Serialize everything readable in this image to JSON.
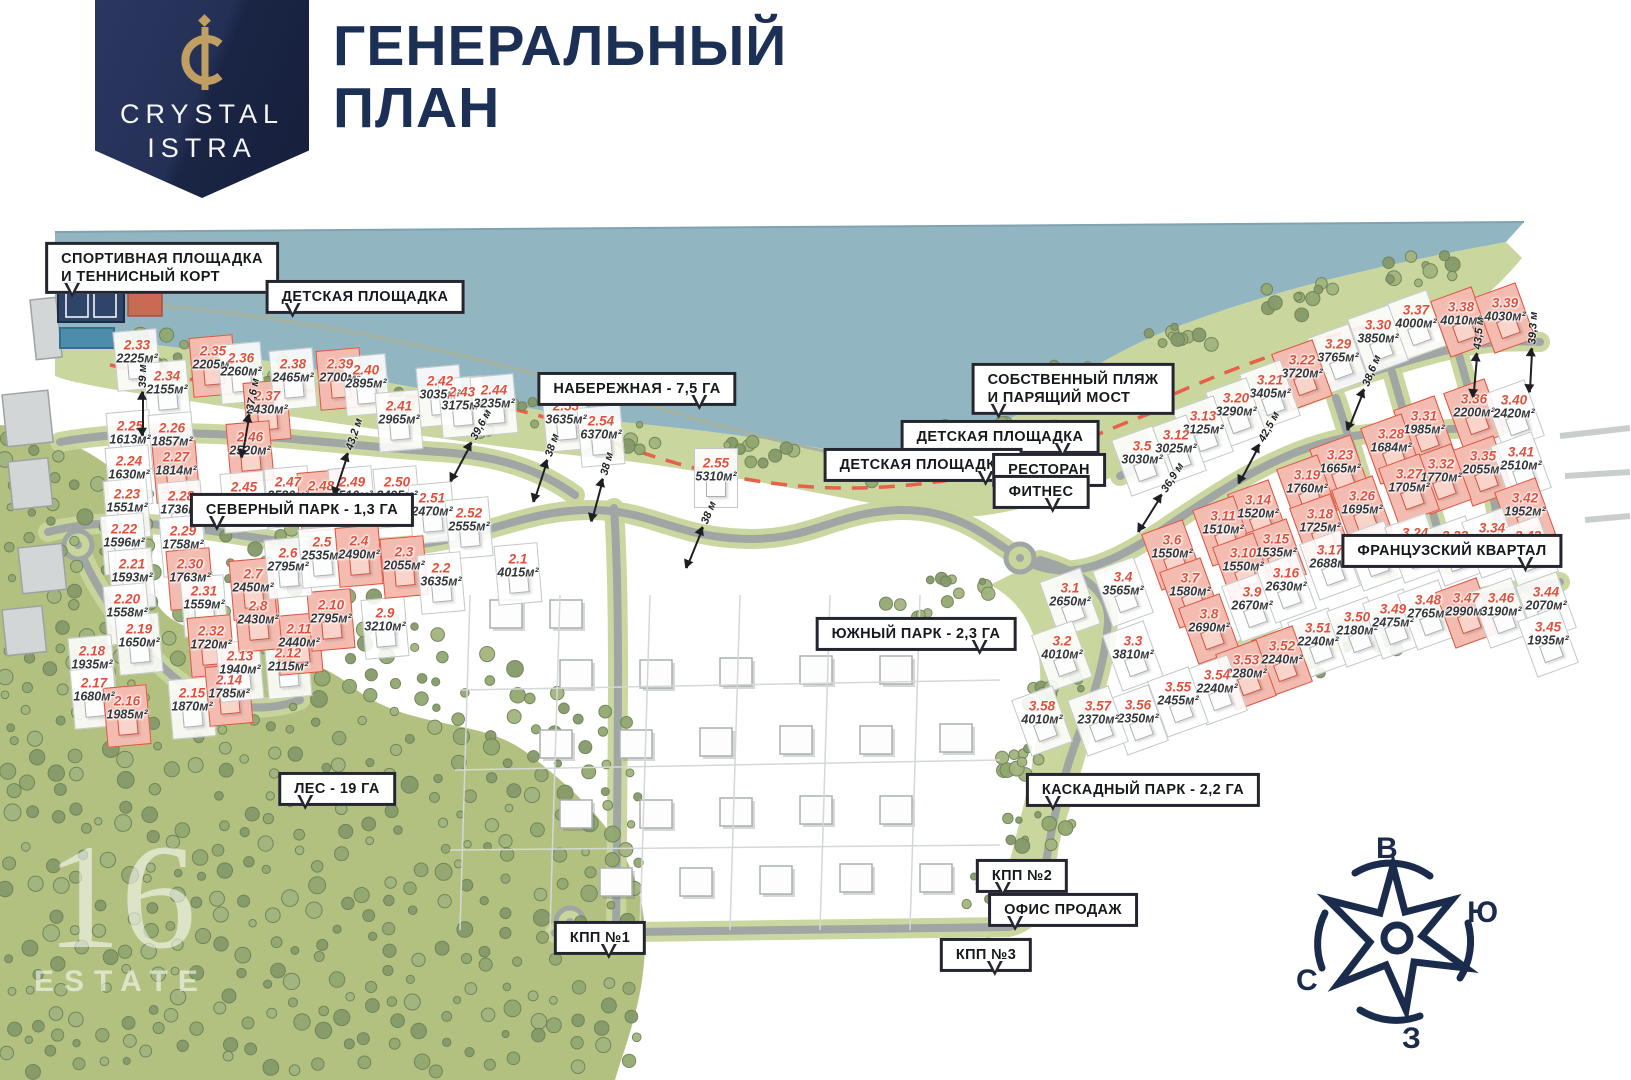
{
  "header": {
    "logo_line1": "CRYSTAL",
    "logo_line2": "ISTRA",
    "title_line1": "ГЕНЕРАЛЬНЫЙ",
    "title_line2": "ПЛАН"
  },
  "colors": {
    "navy": "#1c2f55",
    "gold": "#bf9f62",
    "water": "#92b5c2",
    "shore_green": "#c9d69d",
    "forest_green": "#b3c180",
    "tree_green": "#8ba06c",
    "road_gray": "#a0a6a4",
    "road_edge_green": "#c8d59b",
    "plot_number_red": "#e2503c",
    "plot_red_fill": "#f4bcb1",
    "plot_red_border": "#dd5642",
    "dashed_line_red": "#e8604c"
  },
  "callouts": [
    {
      "id": "sport-ground",
      "lines": [
        "СПОРТИВНАЯ ПЛОЩАДКА",
        "И ТЕННИСНЫЙ КОРТ"
      ],
      "x": 162,
      "y": 268,
      "tail": "bl"
    },
    {
      "id": "playground-nw",
      "lines": [
        "ДЕТСКАЯ ПЛОЩАДКА"
      ],
      "x": 365,
      "y": 297,
      "tail": "bl"
    },
    {
      "id": "embankment",
      "lines": [
        "НАБЕРЕЖНАЯ - 7,5 ГА"
      ],
      "x": 637,
      "y": 389,
      "tail": "br"
    },
    {
      "id": "own-beach",
      "lines": [
        "СОБСТВЕННЫЙ ПЛЯЖ",
        "И ПАРЯЩИЙ МОСТ"
      ],
      "x": 1073,
      "y": 389,
      "tail": "bl"
    },
    {
      "id": "playground-e",
      "lines": [
        "ДЕТСКАЯ ПЛОЩАДКА"
      ],
      "x": 1000,
      "y": 437,
      "tail": "br"
    },
    {
      "id": "playground-c",
      "lines": [
        "ДЕТСКАЯ ПЛОЩАДКА"
      ],
      "x": 923,
      "y": 465,
      "tail": "br"
    },
    {
      "id": "restaurant",
      "lines": [
        "РЕСТОРАН"
      ],
      "x": 1049,
      "y": 470,
      "tail": "br"
    },
    {
      "id": "fitness",
      "lines": [
        "ФИТНЕС"
      ],
      "x": 1041,
      "y": 492,
      "tail": "br"
    },
    {
      "id": "north-park",
      "lines": [
        "СЕВЕРНЫЙ ПАРК - 1,3 ГА"
      ],
      "x": 302,
      "y": 510,
      "tail": "bl"
    },
    {
      "id": "south-park",
      "lines": [
        "ЮЖНЫЙ ПАРК - 2,3 ГА"
      ],
      "x": 916,
      "y": 634,
      "tail": "br"
    },
    {
      "id": "french-quarter",
      "lines": [
        "ФРАНЦУЗСКИЙ КВАРТАЛ"
      ],
      "x": 1452,
      "y": 551,
      "tail": "br"
    },
    {
      "id": "forest",
      "lines": [
        "ЛЕС - 19 ГА"
      ],
      "x": 337,
      "y": 789,
      "tail": "bl"
    },
    {
      "id": "cascade-park",
      "lines": [
        "КАСКАДНЫЙ ПАРК - 2,2 ГА"
      ],
      "x": 1143,
      "y": 790,
      "tail": "bl"
    },
    {
      "id": "kpp2",
      "lines": [
        "КПП №2"
      ],
      "x": 1022,
      "y": 876,
      "tail": "bl"
    },
    {
      "id": "sales-office",
      "lines": [
        "ОФИС ПРОДАЖ"
      ],
      "x": 1063,
      "y": 910,
      "tail": "bl"
    },
    {
      "id": "kpp1",
      "lines": [
        "КПП №1"
      ],
      "x": 600,
      "y": 938,
      "tail": "br"
    },
    {
      "id": "kpp3",
      "lines": [
        "КПП №3"
      ],
      "x": 986,
      "y": 955,
      "tail": "br"
    }
  ],
  "plots": [
    {
      "id": "2.33",
      "area": "2225м²",
      "x": 137,
      "y": 352,
      "red": false
    },
    {
      "id": "2.34",
      "area": "2155м²",
      "x": 167,
      "y": 383,
      "red": false
    },
    {
      "id": "2.35",
      "area": "2205м²",
      "x": 213,
      "y": 358,
      "red": true
    },
    {
      "id": "2.36",
      "area": "2260м²",
      "x": 241,
      "y": 365,
      "red": false
    },
    {
      "id": "2.37",
      "area": "2430м²",
      "x": 267,
      "y": 403,
      "red": true
    },
    {
      "id": "2.38",
      "area": "2465м²",
      "x": 293,
      "y": 371,
      "red": false
    },
    {
      "id": "2.39",
      "area": "2700м²",
      "x": 340,
      "y": 371,
      "red": true
    },
    {
      "id": "2.40",
      "area": "2895м²",
      "x": 366,
      "y": 377,
      "red": false
    },
    {
      "id": "2.41",
      "area": "2965м²",
      "x": 399,
      "y": 413,
      "red": false
    },
    {
      "id": "2.42",
      "area": "3035м²",
      "x": 440,
      "y": 388,
      "red": false
    },
    {
      "id": "2.43",
      "area": "3175м²",
      "x": 462,
      "y": 399,
      "red": false
    },
    {
      "id": "2.44",
      "area": "3235м²",
      "x": 494,
      "y": 397,
      "red": false
    },
    {
      "id": "2.53",
      "area": "3635м²",
      "x": 566,
      "y": 413,
      "red": false
    },
    {
      "id": "2.54",
      "area": "6370м²",
      "x": 601,
      "y": 428,
      "red": false
    },
    {
      "id": "2.55",
      "area": "5310м²",
      "x": 716,
      "y": 470,
      "red": false
    },
    {
      "id": "2.25",
      "area": "1613м²",
      "x": 130,
      "y": 433,
      "red": false
    },
    {
      "id": "2.26",
      "area": "1857м²",
      "x": 172,
      "y": 435,
      "red": false
    },
    {
      "id": "2.24",
      "area": "1630м²",
      "x": 129,
      "y": 468,
      "red": false
    },
    {
      "id": "2.27",
      "area": "1814м²",
      "x": 176,
      "y": 464,
      "red": true
    },
    {
      "id": "2.46",
      "area": "2520м²",
      "x": 250,
      "y": 444,
      "red": true
    },
    {
      "id": "2.45",
      "area": "2400м²",
      "x": 244,
      "y": 494,
      "red": false
    },
    {
      "id": "2.47",
      "area": "2580м²",
      "x": 288,
      "y": 489,
      "red": false
    },
    {
      "id": "2.48",
      "area": "2520м²",
      "x": 321,
      "y": 493,
      "red": true
    },
    {
      "id": "2.49",
      "area": "2510м²",
      "x": 352,
      "y": 489,
      "red": false
    },
    {
      "id": "2.50",
      "area": "2495м²",
      "x": 397,
      "y": 489,
      "red": false
    },
    {
      "id": "2.51",
      "area": "2470м²",
      "x": 432,
      "y": 505,
      "red": false
    },
    {
      "id": "2.52",
      "area": "2555м²",
      "x": 469,
      "y": 520,
      "red": false
    },
    {
      "id": "2.23",
      "area": "1551м²",
      "x": 127,
      "y": 501,
      "red": false
    },
    {
      "id": "2.28",
      "area": "1736м²",
      "x": 181,
      "y": 503,
      "red": false
    },
    {
      "id": "2.22",
      "area": "1596м²",
      "x": 124,
      "y": 536,
      "red": false
    },
    {
      "id": "2.29",
      "area": "1758м²",
      "x": 183,
      "y": 538,
      "red": false
    },
    {
      "id": "2.21",
      "area": "1593м²",
      "x": 132,
      "y": 571,
      "red": false
    },
    {
      "id": "2.30",
      "area": "1763м²",
      "x": 190,
      "y": 571,
      "red": true
    },
    {
      "id": "2.20",
      "area": "1558м²",
      "x": 127,
      "y": 606,
      "red": false
    },
    {
      "id": "2.31",
      "area": "1559м²",
      "x": 204,
      "y": 598,
      "red": false
    },
    {
      "id": "2.19",
      "area": "1650м²",
      "x": 139,
      "y": 636,
      "red": false
    },
    {
      "id": "2.32",
      "area": "1720м²",
      "x": 211,
      "y": 638,
      "red": true
    },
    {
      "id": "2.18",
      "area": "1935м²",
      "x": 92,
      "y": 658,
      "red": false
    },
    {
      "id": "2.17",
      "area": "1680м²",
      "x": 94,
      "y": 690,
      "red": false
    },
    {
      "id": "2.16",
      "area": "1985м²",
      "x": 127,
      "y": 708,
      "red": true
    },
    {
      "id": "2.15",
      "area": "1870м²",
      "x": 192,
      "y": 700,
      "red": false
    },
    {
      "id": "2.14",
      "area": "1785м²",
      "x": 229,
      "y": 687,
      "red": true
    },
    {
      "id": "2.13",
      "area": "1940м²",
      "x": 240,
      "y": 663,
      "red": false
    },
    {
      "id": "2.12",
      "area": "2115м²",
      "x": 288,
      "y": 660,
      "red": false
    },
    {
      "id": "2.11",
      "area": "2440м²",
      "x": 299,
      "y": 636,
      "red": true
    },
    {
      "id": "2.10",
      "area": "2795м²",
      "x": 331,
      "y": 612,
      "red": true
    },
    {
      "id": "2.9",
      "area": "3210м²",
      "x": 385,
      "y": 620,
      "red": false
    },
    {
      "id": "2.8",
      "area": "2430м²",
      "x": 258,
      "y": 613,
      "red": true
    },
    {
      "id": "2.7",
      "area": "2450м²",
      "x": 253,
      "y": 581,
      "red": true
    },
    {
      "id": "2.6",
      "area": "2795м²",
      "x": 288,
      "y": 560,
      "red": false
    },
    {
      "id": "2.5",
      "area": "2535м²",
      "x": 322,
      "y": 549,
      "red": false
    },
    {
      "id": "2.4",
      "area": "2490м²",
      "x": 359,
      "y": 548,
      "red": true
    },
    {
      "id": "2.3",
      "area": "2055м²",
      "x": 404,
      "y": 559,
      "red": true
    },
    {
      "id": "2.2",
      "area": "3635м²",
      "x": 441,
      "y": 575,
      "red": false
    },
    {
      "id": "2.1",
      "area": "4015м²",
      "x": 518,
      "y": 566,
      "red": false
    },
    {
      "id": "3.37",
      "area": "4000м²",
      "x": 1416,
      "y": 317,
      "red": false
    },
    {
      "id": "3.38",
      "area": "4010м²",
      "x": 1461,
      "y": 314,
      "red": true
    },
    {
      "id": "3.39",
      "area": "4030м²",
      "x": 1505,
      "y": 310,
      "red": true
    },
    {
      "id": "3.30",
      "area": "3850м²",
      "x": 1378,
      "y": 332,
      "red": false
    },
    {
      "id": "3.29",
      "area": "3765м²",
      "x": 1338,
      "y": 351,
      "red": false
    },
    {
      "id": "3.22",
      "area": "3720м²",
      "x": 1302,
      "y": 367,
      "red": true
    },
    {
      "id": "3.21",
      "area": "3405м²",
      "x": 1270,
      "y": 387,
      "red": false
    },
    {
      "id": "3.20",
      "area": "3290м²",
      "x": 1236,
      "y": 405,
      "red": false
    },
    {
      "id": "3.13",
      "area": "3125м²",
      "x": 1203,
      "y": 423,
      "red": false
    },
    {
      "id": "3.12",
      "area": "3025м²",
      "x": 1176,
      "y": 442,
      "red": false
    },
    {
      "id": "3.5",
      "area": "3030м²",
      "x": 1142,
      "y": 453,
      "red": false
    },
    {
      "id": "3.36",
      "area": "2200м²",
      "x": 1474,
      "y": 406,
      "red": true
    },
    {
      "id": "3.40",
      "area": "2420м²",
      "x": 1514,
      "y": 407,
      "red": false
    },
    {
      "id": "3.31",
      "area": "1985м²",
      "x": 1424,
      "y": 423,
      "red": true
    },
    {
      "id": "3.28",
      "area": "1684м²",
      "x": 1391,
      "y": 441,
      "red": true
    },
    {
      "id": "3.35",
      "area": "2055м²",
      "x": 1483,
      "y": 463,
      "red": true
    },
    {
      "id": "3.41",
      "area": "2510м²",
      "x": 1521,
      "y": 459,
      "red": false
    },
    {
      "id": "3.32",
      "area": "1770м²",
      "x": 1441,
      "y": 471,
      "red": true
    },
    {
      "id": "3.27",
      "area": "1705м²",
      "x": 1409,
      "y": 481,
      "red": true
    },
    {
      "id": "3.42",
      "area": "1952м²",
      "x": 1525,
      "y": 505,
      "red": true
    },
    {
      "id": "3.23",
      "area": "1665м²",
      "x": 1340,
      "y": 462,
      "red": true
    },
    {
      "id": "3.19",
      "area": "1760м²",
      "x": 1307,
      "y": 482,
      "red": true
    },
    {
      "id": "3.26",
      "area": "1695м²",
      "x": 1362,
      "y": 503,
      "red": true
    },
    {
      "id": "3.14",
      "area": "1520м²",
      "x": 1258,
      "y": 507,
      "red": true
    },
    {
      "id": "3.18",
      "area": "1725м²",
      "x": 1320,
      "y": 521,
      "red": true
    },
    {
      "id": "3.11",
      "area": "1510м²",
      "x": 1223,
      "y": 523,
      "red": true
    },
    {
      "id": "3.15",
      "area": "1535м²",
      "x": 1276,
      "y": 546,
      "red": true
    },
    {
      "id": "3.6",
      "area": "1550м²",
      "x": 1172,
      "y": 547,
      "red": true
    },
    {
      "id": "3.10",
      "area": "1550м²",
      "x": 1243,
      "y": 560,
      "red": true
    },
    {
      "id": "3.25",
      "area": "2665м²",
      "x": 1374,
      "y": 548,
      "red": false
    },
    {
      "id": "3.17",
      "area": "2688м²",
      "x": 1330,
      "y": 557,
      "red": false
    },
    {
      "id": "3.24",
      "area": "2740м²",
      "x": 1415,
      "y": 540,
      "red": false
    },
    {
      "id": "3.33",
      "area": "2860м²",
      "x": 1455,
      "y": 543,
      "red": false
    },
    {
      "id": "3.34",
      "area": "3220м²",
      "x": 1492,
      "y": 535,
      "red": false
    },
    {
      "id": "3.43",
      "area": "2060м²",
      "x": 1528,
      "y": 543,
      "red": false
    },
    {
      "id": "3.7",
      "area": "1580м²",
      "x": 1190,
      "y": 585,
      "red": true
    },
    {
      "id": "3.9",
      "area": "2670м²",
      "x": 1252,
      "y": 599,
      "red": false
    },
    {
      "id": "3.8",
      "area": "2690м²",
      "x": 1209,
      "y": 621,
      "red": true
    },
    {
      "id": "3.16",
      "area": "2630м²",
      "x": 1286,
      "y": 580,
      "red": false
    },
    {
      "id": "3.1",
      "area": "2650м²",
      "x": 1070,
      "y": 595,
      "red": false
    },
    {
      "id": "3.4",
      "area": "3565м²",
      "x": 1123,
      "y": 584,
      "red": false
    },
    {
      "id": "3.2",
      "area": "4010м²",
      "x": 1062,
      "y": 648,
      "red": false
    },
    {
      "id": "3.3",
      "area": "3810м²",
      "x": 1133,
      "y": 648,
      "red": false
    },
    {
      "id": "3.51",
      "area": "2240м²",
      "x": 1318,
      "y": 635,
      "red": false
    },
    {
      "id": "3.50",
      "area": "2180м²",
      "x": 1357,
      "y": 624,
      "red": false
    },
    {
      "id": "3.49",
      "area": "2475м²",
      "x": 1393,
      "y": 616,
      "red": false
    },
    {
      "id": "3.48",
      "area": "2765м²",
      "x": 1428,
      "y": 607,
      "red": false
    },
    {
      "id": "3.47",
      "area": "2990м²",
      "x": 1466,
      "y": 605,
      "red": true
    },
    {
      "id": "3.46",
      "area": "3190м²",
      "x": 1501,
      "y": 605,
      "red": false
    },
    {
      "id": "3.44",
      "area": "2070м²",
      "x": 1546,
      "y": 599,
      "red": false
    },
    {
      "id": "3.45",
      "area": "1935м²",
      "x": 1548,
      "y": 634,
      "red": false
    },
    {
      "id": "3.52",
      "area": "2240м²",
      "x": 1282,
      "y": 653,
      "red": true
    },
    {
      "id": "3.53",
      "area": "2280м²",
      "x": 1246,
      "y": 667,
      "red": true
    },
    {
      "id": "3.54",
      "area": "2240м²",
      "x": 1217,
      "y": 682,
      "red": false
    },
    {
      "id": "3.55",
      "area": "2455м²",
      "x": 1178,
      "y": 694,
      "red": false
    },
    {
      "id": "3.56",
      "area": "2350м²",
      "x": 1138,
      "y": 712,
      "red": false
    },
    {
      "id": "3.57",
      "area": "2370м²",
      "x": 1098,
      "y": 713,
      "red": false
    },
    {
      "id": "3.58",
      "area": "4010м²",
      "x": 1042,
      "y": 713,
      "red": false
    }
  ],
  "measurements": [
    {
      "text": "39 м",
      "x": 143,
      "y": 400,
      "angle": -90
    },
    {
      "text": "37,6 м",
      "x": 249,
      "y": 418,
      "angle": -80
    },
    {
      "text": "43,2 м",
      "x": 347,
      "y": 457,
      "angle": -72
    },
    {
      "text": "39,6 м",
      "x": 470,
      "y": 446,
      "angle": -62
    },
    {
      "text": "38 м",
      "x": 545,
      "y": 468,
      "angle": -72
    },
    {
      "text": "38 м",
      "x": 601,
      "y": 487,
      "angle": -75
    },
    {
      "text": "38 м",
      "x": 700,
      "y": 535,
      "angle": -68
    },
    {
      "text": "43,5 м",
      "x": 1477,
      "y": 357,
      "angle": -85
    },
    {
      "text": "39,3 м",
      "x": 1532,
      "y": 352,
      "angle": -87
    },
    {
      "text": "38,6 м",
      "x": 1363,
      "y": 393,
      "angle": -68
    },
    {
      "text": "42,5 м",
      "x": 1258,
      "y": 448,
      "angle": -62
    },
    {
      "text": "36,9 м",
      "x": 1160,
      "y": 498,
      "angle": -58
    }
  ],
  "compass": {
    "top": "В",
    "right": "Ю",
    "left": "С",
    "bottom": "З"
  },
  "watermark": {
    "monogram": "16",
    "label": "ESTATE"
  }
}
